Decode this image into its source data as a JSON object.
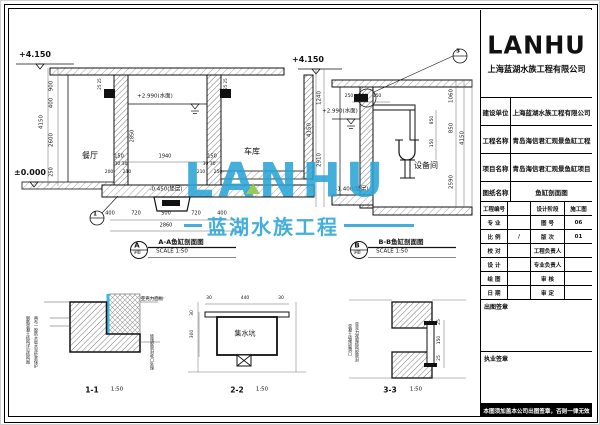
{
  "sheet": {
    "logo_text": "LANHU",
    "company": "上海蓝湖水族工程有限公司",
    "info_rows": [
      {
        "label": "建设单位",
        "value": "上海蓝湖水族工程有限公司"
      },
      {
        "label": "工程名称",
        "value": "青岛海信君汇观景鱼缸工程"
      },
      {
        "label": "项目名称",
        "value": "青岛海信君汇观景鱼缸项目"
      },
      {
        "label": "图纸名称",
        "value": "鱼缸剖面图"
      }
    ],
    "small_rows": [
      {
        "l1": "工程编号",
        "v1": "",
        "l2": "设计阶段",
        "v2": "施工图"
      },
      {
        "l1": "专 业",
        "v1": "",
        "l2": "图 号",
        "v2": "06"
      },
      {
        "l1": "比 例",
        "v1": "/",
        "l2": "版 次",
        "v2": "01"
      },
      {
        "l1": "校 对",
        "v1": "",
        "l2": "工程负责人",
        "v2": ""
      },
      {
        "l1": "设 计",
        "v1": "",
        "l2": "专业负责人",
        "v2": ""
      },
      {
        "l1": "绘 图",
        "v1": "",
        "l2": "审 核",
        "v2": ""
      },
      {
        "l1": "日 期",
        "v1": "",
        "l2": "审 定",
        "v2": ""
      }
    ],
    "stamp1": "出图签章",
    "stamp2": "执业签章",
    "footer_note": "本图须加盖本公司出图签章，否则一律无效"
  },
  "watermark": {
    "logo": "LANHU",
    "text": "蓝湖水族工程",
    "blue": "#2AA5D6",
    "green": "#8CC63E"
  },
  "annotations": [
    {
      "t": "+4.150",
      "x": 35,
      "y": 55,
      "s": 8,
      "b": 1,
      "n": "level-mark"
    },
    {
      "t": "±0.000",
      "x": 30,
      "y": 173,
      "s": 8,
      "b": 1,
      "n": "level-mark"
    },
    {
      "t": "+2.990(水面)",
      "x": 155,
      "y": 97,
      "s": 5.5,
      "n": "water-level-label"
    },
    {
      "t": "-0.450(垫层)",
      "x": 166,
      "y": 190,
      "s": 5.5,
      "n": "level-mark"
    },
    {
      "t": "餐厅",
      "x": 90,
      "y": 156,
      "s": 8,
      "n": "room-label"
    },
    {
      "t": "车库",
      "x": 252,
      "y": 152,
      "s": 8,
      "n": "room-label"
    },
    {
      "t": "900",
      "x": 52,
      "y": 86,
      "s": 5.5,
      "r": -90
    },
    {
      "t": "400",
      "x": 52,
      "y": 103,
      "s": 5.5,
      "r": -90
    },
    {
      "t": "2600",
      "x": 52,
      "y": 140,
      "s": 5.5,
      "r": -90
    },
    {
      "t": "250",
      "x": 52,
      "y": 172,
      "s": 5,
      "r": -90
    },
    {
      "t": "4150",
      "x": 42,
      "y": 122,
      "s": 5.5,
      "r": -90
    },
    {
      "t": "2850",
      "x": 133,
      "y": 136,
      "s": 5,
      "r": -90
    },
    {
      "t": "150",
      "x": 119,
      "y": 157,
      "s": 5
    },
    {
      "t": "1940",
      "x": 165,
      "y": 157,
      "s": 5
    },
    {
      "t": "150",
      "x": 212,
      "y": 157,
      "s": 5
    },
    {
      "t": "30 30",
      "x": 121,
      "y": 165,
      "s": 4.5
    },
    {
      "t": "30 30",
      "x": 209,
      "y": 165,
      "s": 4.5
    },
    {
      "t": "200",
      "x": 109,
      "y": 173,
      "s": 4.5
    },
    {
      "t": "210",
      "x": 127,
      "y": 173,
      "s": 4.5
    },
    {
      "t": "210",
      "x": 201,
      "y": 173,
      "s": 4.5
    },
    {
      "t": "250",
      "x": 218,
      "y": 173,
      "s": 4.5
    },
    {
      "t": "25 25",
      "x": 100,
      "y": 84,
      "s": 4,
      "r": -90
    },
    {
      "t": "25 25",
      "x": 226,
      "y": 84,
      "s": 4,
      "r": -90
    },
    {
      "t": "400",
      "x": 110,
      "y": 214,
      "s": 5
    },
    {
      "t": "720",
      "x": 136,
      "y": 214,
      "s": 5
    },
    {
      "t": "500",
      "x": 166,
      "y": 214,
      "s": 5
    },
    {
      "t": "720",
      "x": 196,
      "y": 214,
      "s": 5
    },
    {
      "t": "400",
      "x": 222,
      "y": 214,
      "s": 5
    },
    {
      "t": "2860",
      "x": 166,
      "y": 226,
      "s": 5
    },
    {
      "t": "1",
      "x": 95,
      "y": 215,
      "s": 5.5,
      "b": 1,
      "n": "detail-bubble-number"
    },
    {
      "t": "A",
      "x": 137,
      "y": 246,
      "s": 7,
      "b": 1,
      "n": "section-bubble-letter"
    },
    {
      "t": "详图",
      "x": 137,
      "y": 253,
      "s": 3.5
    },
    {
      "t": "A-A鱼缸剖面图",
      "x": 181,
      "y": 242,
      "s": 6.5,
      "b": 1,
      "n": "section-title"
    },
    {
      "t": "SCALE  1:50",
      "x": 172,
      "y": 252,
      "s": 5.5,
      "n": "section-scale"
    },
    {
      "t": "+4.150",
      "x": 308,
      "y": 60,
      "s": 8,
      "b": 1,
      "n": "level-mark"
    },
    {
      "t": "+2.990(水面)",
      "x": 340,
      "y": 112,
      "s": 5.5,
      "n": "water-level-label"
    },
    {
      "t": "-1.400(垫层)",
      "x": 352,
      "y": 190,
      "s": 5.5,
      "n": "level-mark"
    },
    {
      "t": "设备间",
      "x": 426,
      "y": 166,
      "s": 8,
      "n": "room-label"
    },
    {
      "t": "1240",
      "x": 320,
      "y": 98,
      "s": 5.5,
      "r": -90
    },
    {
      "t": "2910",
      "x": 320,
      "y": 160,
      "s": 5.5,
      "r": -90
    },
    {
      "t": "4150",
      "x": 310,
      "y": 130,
      "s": 5.5,
      "r": -90
    },
    {
      "t": "250",
      "x": 349,
      "y": 97,
      "s": 4.5
    },
    {
      "t": "500",
      "x": 363,
      "y": 97,
      "s": 4.5
    },
    {
      "t": "150",
      "x": 377,
      "y": 97,
      "s": 4.5
    },
    {
      "t": "850",
      "x": 433,
      "y": 120,
      "s": 4.5,
      "r": -90
    },
    {
      "t": "150",
      "x": 433,
      "y": 143,
      "s": 4.5,
      "r": -90
    },
    {
      "t": "1060",
      "x": 452,
      "y": 96,
      "s": 5.5,
      "r": -90
    },
    {
      "t": "850",
      "x": 452,
      "y": 128,
      "s": 5.5,
      "r": -90
    },
    {
      "t": "2590",
      "x": 452,
      "y": 182,
      "s": 5.5,
      "r": -90
    },
    {
      "t": "4150",
      "x": 463,
      "y": 138,
      "s": 5.5,
      "r": -90
    },
    {
      "t": "3",
      "x": 458,
      "y": 52,
      "s": 5.5,
      "b": 1,
      "n": "detail-bubble-number"
    },
    {
      "t": "B",
      "x": 357,
      "y": 246,
      "s": 7,
      "b": 1,
      "n": "section-bubble-letter"
    },
    {
      "t": "详图",
      "x": 357,
      "y": 253,
      "s": 3.5
    },
    {
      "t": "B-B鱼缸剖面图",
      "x": 401,
      "y": 242,
      "s": 6.5,
      "b": 1,
      "n": "section-title"
    },
    {
      "t": "SCALE  1:50",
      "x": 392,
      "y": 252,
      "s": 5.5,
      "n": "section-scale"
    },
    {
      "t": "亚克力面板",
      "x": 152,
      "y": 300,
      "s": 4.5,
      "n": "material-label"
    },
    {
      "t": "钢筋混凝土结构详见结构图",
      "x": 28,
      "y": 340,
      "s": 4,
      "v": 1,
      "n": "material-note"
    },
    {
      "t": "两布一胶防水层水泥砂浆保护",
      "x": 36,
      "y": 342,
      "s": 4,
      "v": 1,
      "n": "material-note"
    },
    {
      "t": "玻璃胶密封收口处理",
      "x": 152,
      "y": 352,
      "s": 4,
      "v": 1,
      "n": "material-note"
    },
    {
      "t": "1-1",
      "x": 92,
      "y": 390,
      "s": 7.5,
      "b": 1,
      "n": "detail-title"
    },
    {
      "t": "1:50",
      "x": 117,
      "y": 390,
      "s": 5.5,
      "n": "detail-scale"
    },
    {
      "t": "30",
      "x": 209,
      "y": 299,
      "s": 4.5
    },
    {
      "t": "440",
      "x": 245,
      "y": 299,
      "s": 4.5
    },
    {
      "t": "30",
      "x": 281,
      "y": 299,
      "s": 4.5
    },
    {
      "t": "30",
      "x": 193,
      "y": 313,
      "s": 4.5,
      "r": -90
    },
    {
      "t": "300",
      "x": 193,
      "y": 334,
      "s": 4.5,
      "r": -90
    },
    {
      "t": "集水坑",
      "x": 245,
      "y": 334,
      "s": 7,
      "n": "sump-pit-label"
    },
    {
      "t": "2-2",
      "x": 237,
      "y": 390,
      "s": 7.5,
      "b": 1,
      "n": "detail-title"
    },
    {
      "t": "1:50",
      "x": 262,
      "y": 390,
      "s": 5.5,
      "n": "detail-scale"
    },
    {
      "t": "25",
      "x": 440,
      "y": 322,
      "s": 4.5,
      "r": -90
    },
    {
      "t": "150",
      "x": 440,
      "y": 340,
      "s": 4.5,
      "r": -90
    },
    {
      "t": "25",
      "x": 440,
      "y": 358,
      "s": 4.5,
      "r": -90
    },
    {
      "t": "混凝土墙预留洞口",
      "x": 350,
      "y": 340,
      "s": 4,
      "v": 1,
      "n": "material-note"
    },
    {
      "t": "亚克力视窗结构胶密封",
      "x": 357,
      "y": 342,
      "s": 4,
      "v": 1,
      "n": "material-note"
    },
    {
      "t": "3-3",
      "x": 390,
      "y": 390,
      "s": 7.5,
      "b": 1,
      "n": "detail-title"
    },
    {
      "t": "1:50",
      "x": 416,
      "y": 390,
      "s": 5.5,
      "n": "detail-scale"
    }
  ]
}
